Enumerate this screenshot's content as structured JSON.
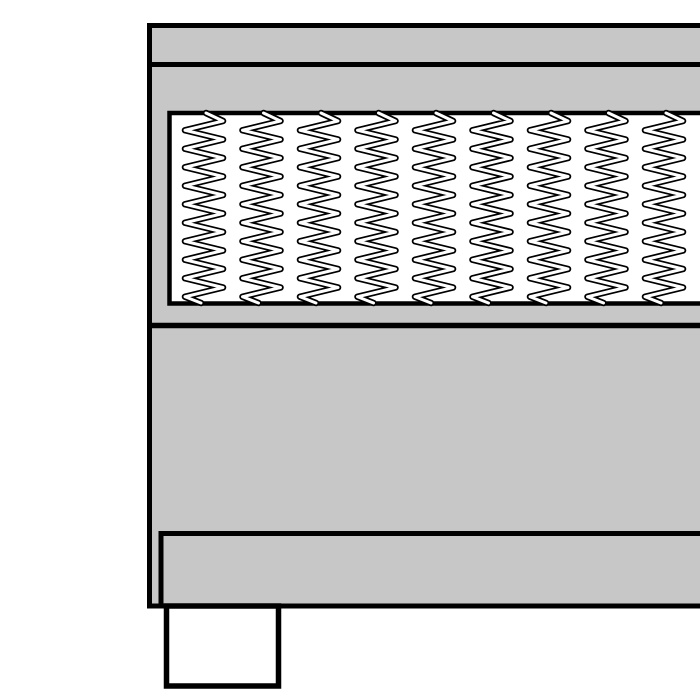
{
  "scene": {
    "name": "box-spring-bed-cross-section",
    "description": "Monochrome line illustration of a divan box-spring bed seen from the side, cropped at the right image edge: upholstered body with top rail, inner pocket-spring panel with coil springs, solid base, inset bottom rail and one square foot/leg at lower left",
    "background_color": "#ffffff",
    "outline_color": "#000000",
    "body_fill_color": "#c7c7c7",
    "panel_fill_color": "#ffffff",
    "leg_fill_color": "#ffffff"
  },
  "parts": {
    "body": {
      "type": "rect",
      "x": 149.5,
      "y": 25.5,
      "w": 565,
      "h": 580.5,
      "stroke": 5,
      "fill": "body"
    },
    "head_line": {
      "type": "line",
      "x1": 147,
      "y1": 64.5,
      "x2": 713,
      "y2": 64.5,
      "stroke": 5
    },
    "spring_panel": {
      "type": "rect",
      "x": 169.5,
      "y": 113,
      "w": 545,
      "h": 190.5,
      "stroke": 4.5,
      "fill": "panel"
    },
    "mid_line": {
      "type": "line",
      "x1": 147,
      "y1": 325.5,
      "x2": 713,
      "y2": 325.5,
      "stroke": 5.5
    },
    "bottom_rail": {
      "type": "rect",
      "x": 161,
      "y": 533.5,
      "w": 552,
      "h": 72.5,
      "stroke": 5,
      "fill": "body"
    },
    "leg": {
      "type": "rect",
      "x": 166.5,
      "y": 606,
      "w": 112,
      "h": 80,
      "stroke": 5.5,
      "fill": "leg"
    }
  },
  "springs": {
    "count": 9,
    "first_center_x": 204,
    "spacing": 57.5,
    "top_y": 113,
    "bottom_y": 303,
    "half_width": 19,
    "first_tip_offset": 8,
    "half_period": 9.25,
    "outer_stroke_width": 6.5,
    "inner_stroke_width": 3,
    "outer_stroke_color": "#000000",
    "inner_stroke_color": "#ffffff"
  }
}
